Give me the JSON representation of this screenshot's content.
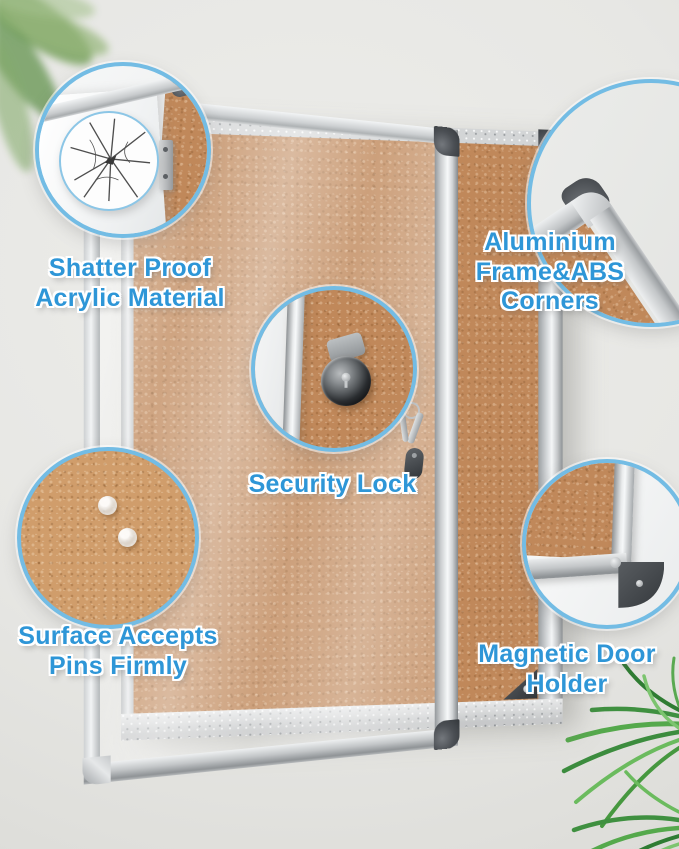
{
  "labels": {
    "shatter": {
      "line1": "Shatter Proof",
      "line2": "Acrylic Material"
    },
    "aluminium": {
      "line1": "Aluminium",
      "line2": "Frame&ABS Corners"
    },
    "security": {
      "line1": "Security Lock"
    },
    "pins": {
      "line1": "Surface Accepts",
      "line2": "Pins Firmly"
    },
    "magnet": {
      "line1": "Magnetic Door",
      "line2": "Holder"
    }
  },
  "colors": {
    "label_blue": "#2e96d7",
    "callout_border": "#73bce4",
    "wall": "#e8e8e5",
    "cork": "#c0885a",
    "cork_light": "#d09d6b",
    "frame_silver": "#ced1d3",
    "abs_dark": "#45494e",
    "plant_green": "#4d9c44"
  },
  "callout_features": [
    "crack-pattern",
    "door-hinge",
    "aluminium-corner-cap",
    "security-lock-cylinder",
    "push-pins",
    "magnetic-door-bracket"
  ]
}
